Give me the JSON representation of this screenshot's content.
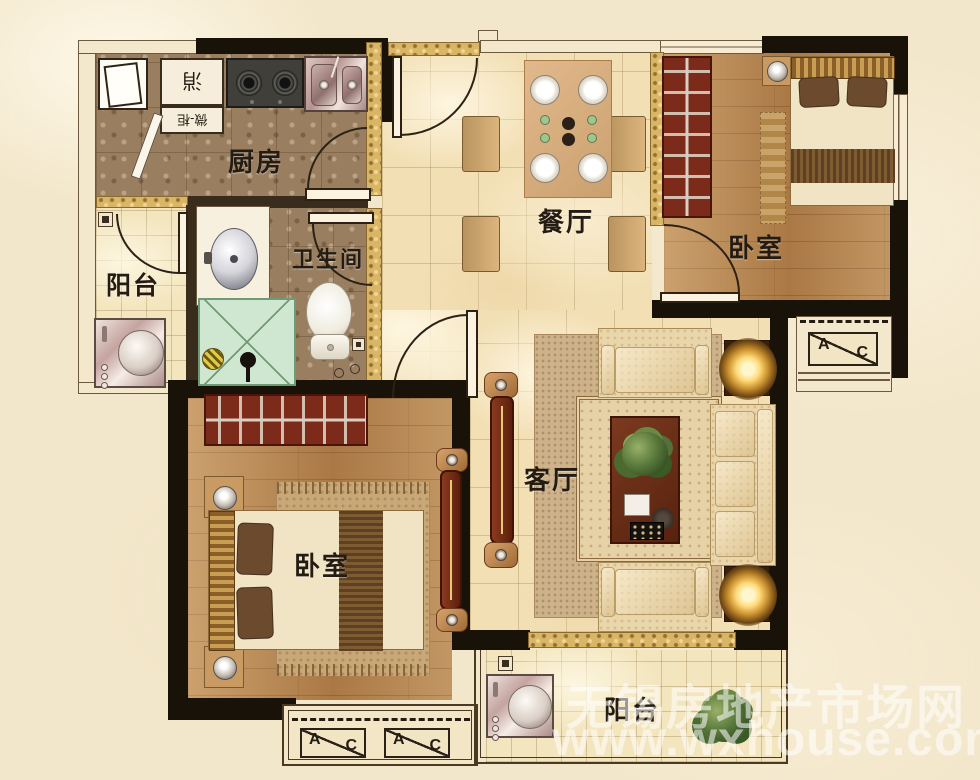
{
  "rooms": {
    "kitchen": {
      "label": "厨房"
    },
    "dining": {
      "label": "餐厅"
    },
    "bedroom_top": {
      "label": "卧室"
    },
    "bedroom_bottom": {
      "label": "卧室"
    },
    "bathroom": {
      "label": "卫生间"
    },
    "living": {
      "label": "客厅"
    },
    "balcony_left": {
      "label": "阳台"
    },
    "balcony_bottom": {
      "label": "阳台"
    }
  },
  "cabinet_labels": {
    "sterilizer": "消",
    "microwave": "微-柜"
  },
  "ac_unit": {
    "a": "A",
    "c": "C"
  },
  "watermark": {
    "line1": "无锡房地产市场网",
    "line2": "www.wxhouse.com"
  },
  "colors": {
    "wall": "#191208",
    "floor_pale": "#f2dfb4",
    "floor_mosaic": "#9a7e60",
    "floor_wood": "#b5854f",
    "accent_gold": "#d9b566",
    "shower_green": "#cfe6d0",
    "wardrobe_red": "#7c2b1a"
  }
}
